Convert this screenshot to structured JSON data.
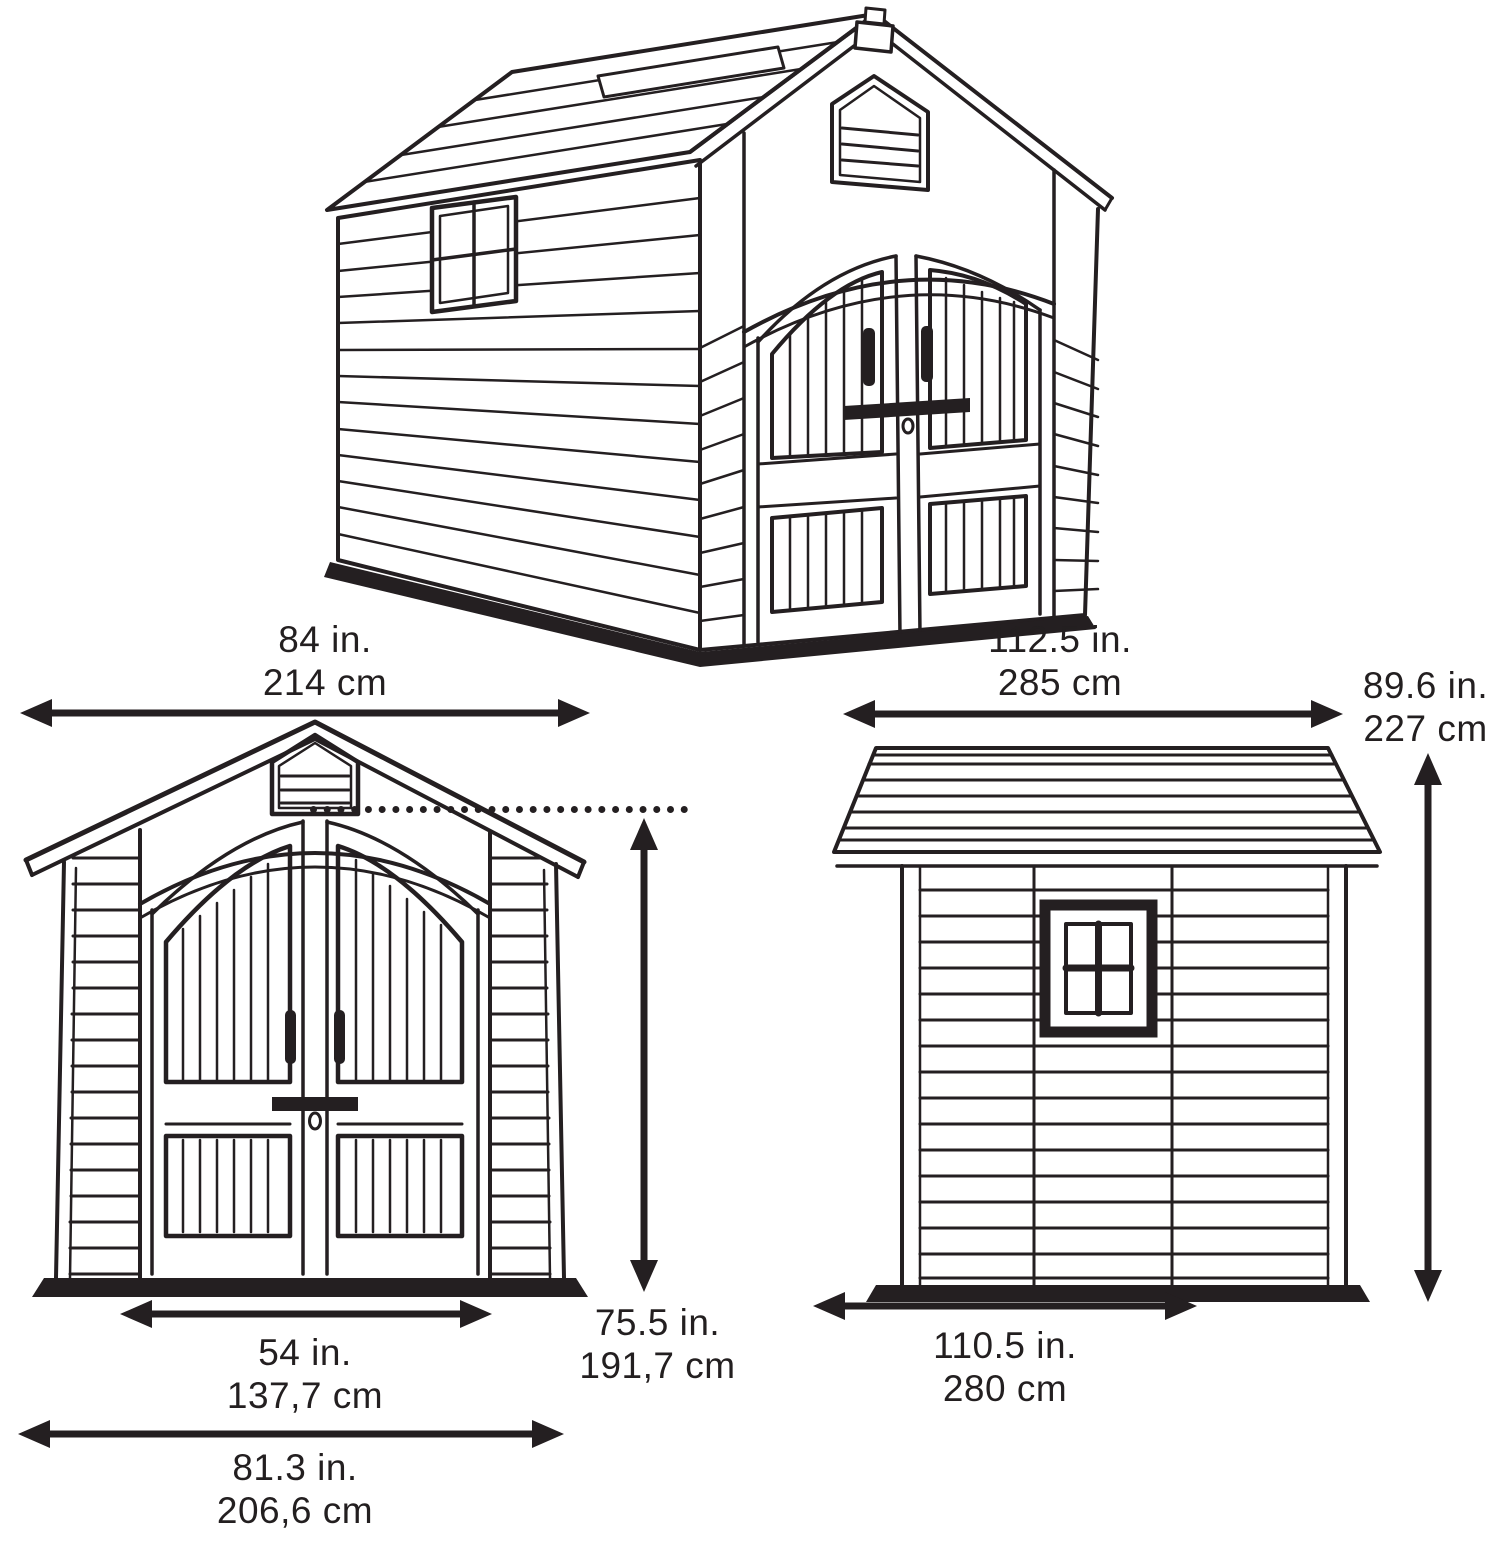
{
  "title": "Storage shed dimension diagram",
  "colors": {
    "line": "#241f21",
    "background": "#ffffff"
  },
  "views": {
    "perspective": {
      "name": "3D perspective view of shed"
    },
    "front": {
      "name": "Front elevation of shed"
    },
    "side": {
      "name": "Side elevation of shed"
    }
  },
  "dimensions": {
    "front_width": {
      "in": "84 in.",
      "cm": "214 cm"
    },
    "depth": {
      "in": "112.5 in.",
      "cm": "285 cm"
    },
    "peak_height": {
      "in": "89.6 in.",
      "cm": "227 cm"
    },
    "door_height": {
      "in": "75.5 in.",
      "cm": "191,7 cm"
    },
    "door_width": {
      "in": "54 in.",
      "cm": "137,7 cm"
    },
    "base_width": {
      "in": "81.3 in.",
      "cm": "206,6 cm"
    },
    "side_length": {
      "in": "110.5 in.",
      "cm": "280 cm"
    }
  }
}
